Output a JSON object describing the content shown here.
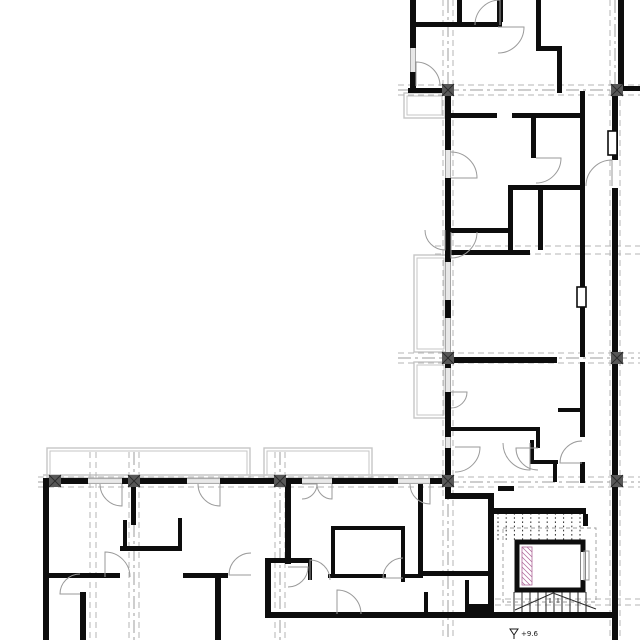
{
  "meta": {
    "title": "Apartment building floor plan",
    "type": "architectural-plan"
  },
  "annotations": {
    "level": "+9.6"
  },
  "colors": {
    "wall": "#0d0d0d",
    "grid_dash": "#b5b5b5",
    "grid_center": "#9e9e9e",
    "door": "#9a9a9a",
    "window": "#8f8f8f",
    "window_mid": "#c4c4c4",
    "balcony": "#c6c6c6",
    "column": "#585858",
    "column_x": "#2a2a2a",
    "hatch": "#b06a9a",
    "tread": "#2a2a2a",
    "walkline": "#9b9b9b",
    "text": "#1a1a1a"
  },
  "canvas": {
    "w": 640,
    "h": 640
  },
  "walls": [
    [
      410,
      0,
      6,
      48
    ],
    [
      410,
      72,
      6,
      21
    ],
    [
      410,
      22,
      92,
      5
    ],
    [
      457,
      0,
      5,
      22
    ],
    [
      497,
      0,
      6,
      22
    ],
    [
      536,
      0,
      5,
      50
    ],
    [
      536,
      46,
      26,
      5
    ],
    [
      557,
      46,
      5,
      47
    ],
    [
      618,
      0,
      6,
      90
    ],
    [
      612,
      86,
      28,
      5
    ],
    [
      408,
      88,
      40,
      5
    ],
    [
      445,
      93,
      6,
      57
    ],
    [
      445,
      178,
      6,
      84
    ],
    [
      445,
      300,
      6,
      18
    ],
    [
      445,
      352,
      6,
      16
    ],
    [
      445,
      392,
      6,
      45
    ],
    [
      445,
      448,
      6,
      45
    ],
    [
      612,
      91,
      6,
      69
    ],
    [
      612,
      188,
      6,
      452
    ],
    [
      451,
      113,
      46,
      5
    ],
    [
      512,
      113,
      70,
      5
    ],
    [
      531,
      113,
      5,
      45
    ],
    [
      508,
      185,
      77,
      5
    ],
    [
      508,
      190,
      5,
      63
    ],
    [
      451,
      228,
      57,
      5
    ],
    [
      451,
      250,
      79,
      5
    ],
    [
      538,
      190,
      5,
      60
    ],
    [
      580,
      91,
      5,
      146
    ],
    [
      580,
      237,
      5,
      50
    ],
    [
      580,
      305,
      5,
      52
    ],
    [
      580,
      362,
      5,
      50
    ],
    [
      580,
      412,
      5,
      25
    ],
    [
      580,
      462,
      5,
      21
    ],
    [
      451,
      357,
      106,
      6
    ],
    [
      558,
      408,
      24,
      4
    ],
    [
      448,
      427,
      92,
      4
    ],
    [
      536,
      427,
      4,
      21
    ],
    [
      445,
      493,
      47,
      6
    ],
    [
      488,
      493,
      6,
      125
    ],
    [
      498,
      486,
      16,
      5
    ],
    [
      530,
      440,
      4,
      24
    ],
    [
      530,
      460,
      28,
      4
    ],
    [
      553,
      460,
      4,
      22
    ],
    [
      488,
      508,
      98,
      6
    ],
    [
      488,
      612,
      124,
      6
    ],
    [
      583,
      514,
      5,
      12
    ],
    [
      43,
      478,
      45,
      6
    ],
    [
      122,
      478,
      65,
      6
    ],
    [
      220,
      478,
      82,
      6
    ],
    [
      332,
      478,
      66,
      6
    ],
    [
      430,
      478,
      21,
      6
    ],
    [
      43,
      484,
      6,
      156
    ],
    [
      131,
      484,
      5,
      41
    ],
    [
      120,
      546,
      62,
      5
    ],
    [
      178,
      518,
      4,
      30
    ],
    [
      123,
      520,
      4,
      28
    ],
    [
      43,
      573,
      77,
      5
    ],
    [
      183,
      573,
      45,
      5
    ],
    [
      80,
      592,
      6,
      48
    ],
    [
      215,
      573,
      6,
      67
    ],
    [
      265,
      558,
      6,
      60
    ],
    [
      265,
      558,
      47,
      5
    ],
    [
      308,
      558,
      4,
      22
    ],
    [
      285,
      484,
      6,
      80
    ],
    [
      331,
      526,
      4,
      52
    ],
    [
      331,
      526,
      74,
      4
    ],
    [
      401,
      526,
      4,
      56
    ],
    [
      418,
      484,
      5,
      94
    ],
    [
      328,
      574,
      58,
      4
    ],
    [
      403,
      574,
      20,
      4
    ],
    [
      423,
      571,
      67,
      5
    ],
    [
      265,
      612,
      225,
      6
    ],
    [
      468,
      604,
      23,
      8
    ],
    [
      424,
      592,
      4,
      20
    ],
    [
      465,
      580,
      4,
      32
    ]
  ],
  "windows": [
    {
      "x": 410,
      "y": 48,
      "w": 6,
      "h": 24,
      "o": "v"
    },
    {
      "x": 445,
      "y": 150,
      "w": 6,
      "h": 28,
      "o": "v"
    },
    {
      "x": 445,
      "y": 262,
      "w": 6,
      "h": 38,
      "o": "v"
    },
    {
      "x": 445,
      "y": 318,
      "w": 6,
      "h": 34,
      "o": "v"
    },
    {
      "x": 445,
      "y": 368,
      "w": 6,
      "h": 24,
      "o": "v"
    },
    {
      "x": 445,
      "y": 437,
      "w": 6,
      "h": 11,
      "o": "v"
    },
    {
      "x": 88,
      "y": 478,
      "w": 34,
      "h": 6,
      "o": "h"
    },
    {
      "x": 187,
      "y": 478,
      "w": 33,
      "h": 6,
      "o": "h"
    },
    {
      "x": 302,
      "y": 478,
      "w": 30,
      "h": 6,
      "o": "h"
    },
    {
      "x": 398,
      "y": 478,
      "w": 32,
      "h": 6,
      "o": "h"
    }
  ],
  "gaps": [
    [
      612,
      160,
      6,
      28
    ]
  ],
  "frames": [
    [
      608,
      131,
      9,
      24
    ],
    [
      577,
      287,
      9,
      20
    ]
  ],
  "doors": [
    {
      "cx": 500,
      "cy": 25,
      "r": 25,
      "a1": 270,
      "a2": 180,
      "s": 0
    },
    {
      "cx": 498,
      "cy": 27,
      "r": 26,
      "a1": 0,
      "a2": 90,
      "s": 1
    },
    {
      "cx": 416,
      "cy": 86,
      "r": 24,
      "a1": 270,
      "a2": 0,
      "s": 1
    },
    {
      "cx": 536,
      "cy": 158,
      "r": 25,
      "a1": 0,
      "a2": 90,
      "s": 1
    },
    {
      "cx": 612,
      "cy": 186,
      "r": 26,
      "a1": 270,
      "a2": 180,
      "s": 0
    },
    {
      "cx": 451,
      "cy": 232,
      "r": 26,
      "a1": 90,
      "a2": 0,
      "s": 0
    },
    {
      "cx": 445,
      "cy": 230,
      "r": 20,
      "a1": 90,
      "a2": 180,
      "s": 1
    },
    {
      "cx": 451,
      "cy": 178,
      "r": 26,
      "a1": 0,
      "a2": 270,
      "s": 0
    },
    {
      "cx": 451,
      "cy": 392,
      "r": 16,
      "a1": 0,
      "a2": 90,
      "s": 1
    },
    {
      "cx": 538,
      "cy": 448,
      "r": 22,
      "a1": 180,
      "a2": 90,
      "s": 0
    },
    {
      "cx": 582,
      "cy": 463,
      "r": 22,
      "a1": 180,
      "a2": 270,
      "s": 1
    },
    {
      "cx": 455,
      "cy": 447,
      "r": 25,
      "a1": 0,
      "a2": 90,
      "s": 1
    },
    {
      "cx": 530,
      "cy": 443,
      "r": 27,
      "a1": 90,
      "a2": 180,
      "s": 1
    },
    {
      "cx": 122,
      "cy": 484,
      "r": 22,
      "a1": 90,
      "a2": 180,
      "s": 1
    },
    {
      "cx": 220,
      "cy": 484,
      "r": 22,
      "a1": 90,
      "a2": 180,
      "s": 1
    },
    {
      "cx": 302,
      "cy": 484,
      "r": 15,
      "a1": 0,
      "a2": 90,
      "s": 1
    },
    {
      "cx": 332,
      "cy": 484,
      "r": 15,
      "a1": 90,
      "a2": 180,
      "s": 1
    },
    {
      "cx": 430,
      "cy": 484,
      "r": 20,
      "a1": 90,
      "a2": 180,
      "s": 1
    },
    {
      "cx": 105,
      "cy": 577,
      "r": 25,
      "a1": 270,
      "a2": 0,
      "s": 1
    },
    {
      "cx": 80,
      "cy": 594,
      "r": 20,
      "a1": 180,
      "a2": 270,
      "s": 1
    },
    {
      "cx": 251,
      "cy": 575,
      "r": 22,
      "a1": 180,
      "a2": 270,
      "s": 1
    },
    {
      "cx": 310,
      "cy": 580,
      "r": 20,
      "a1": 270,
      "a2": 0,
      "s": 1
    },
    {
      "cx": 403,
      "cy": 578,
      "r": 20,
      "a1": 180,
      "a2": 270,
      "s": 1
    },
    {
      "cx": 337,
      "cy": 614,
      "r": 24,
      "a1": 270,
      "a2": 0,
      "s": 1
    },
    {
      "cx": 288,
      "cy": 567,
      "r": 20,
      "a1": 0,
      "a2": 90,
      "s": 1
    }
  ],
  "grids": {
    "v": [
      {
        "x": 448,
        "y1": 0,
        "y2": 640,
        "pair": 5,
        "center": true
      },
      {
        "x": 615,
        "y1": 0,
        "y2": 640,
        "pair": 5,
        "center": true
      },
      {
        "x": 134,
        "y1": 452,
        "y2": 640,
        "pair": 5,
        "center": true
      },
      {
        "x": 280,
        "y1": 452,
        "y2": 640,
        "pair": 5,
        "center": true
      },
      {
        "x": 93,
        "y1": 452,
        "y2": 640,
        "pair": 3,
        "center": false
      }
    ],
    "h": [
      {
        "y": 90,
        "x1": 398,
        "x2": 640,
        "pair": 5,
        "center": true
      },
      {
        "y": 250,
        "x1": 435,
        "x2": 640,
        "pair": 4,
        "center": false
      },
      {
        "y": 358,
        "x1": 398,
        "x2": 640,
        "pair": 5,
        "center": true
      },
      {
        "y": 482,
        "x1": 38,
        "x2": 640,
        "pair": 5,
        "center": true
      },
      {
        "y": 602,
        "x1": 495,
        "x2": 640,
        "pair": 3,
        "center": false
      }
    ]
  },
  "columns": {
    "size": 12,
    "points": [
      [
        448,
        90
      ],
      [
        617,
        90
      ],
      [
        448,
        358
      ],
      [
        617,
        358
      ],
      [
        55,
        481
      ],
      [
        134,
        481
      ],
      [
        280,
        481
      ],
      [
        448,
        481
      ],
      [
        617,
        481
      ]
    ]
  },
  "balconies": [
    [
      47,
      448,
      203,
      30
    ],
    [
      264,
      448,
      108,
      30
    ],
    [
      414,
      255,
      33,
      97
    ],
    [
      414,
      362,
      33,
      56
    ],
    [
      404,
      93,
      41,
      25
    ]
  ],
  "gray_lines": [
    [
      43,
      475,
      448,
      475
    ]
  ],
  "stair": {
    "treads_top": {
      "x1": 498,
      "x2": 580,
      "n": 11,
      "y1": 513,
      "y2": 540,
      "dotted": true
    },
    "treads_bottom": {
      "x1": 514,
      "x2": 586,
      "n": 10,
      "y1": 592,
      "y2": 612,
      "dotted": false
    },
    "arrow": [
      [
        515,
        610
      ],
      [
        553,
        593
      ],
      [
        596,
        609
      ]
    ],
    "walkline": [
      503,
      528,
      93,
      74
    ],
    "label_ticks": [
      [
        546,
        598
      ],
      [
        550,
        598
      ],
      [
        554,
        598
      ],
      [
        558,
        598
      ]
    ]
  },
  "elevator": {
    "x": 517,
    "y": 542,
    "w": 66,
    "h": 48,
    "t": 5,
    "door_gap": {
      "y1": 552,
      "y2": 580
    },
    "hatch": [
      522,
      547,
      10,
      38
    ],
    "slider": [
      584,
      551,
      5,
      29
    ]
  },
  "level_marker": {
    "tri": [
      [
        510,
        629
      ],
      [
        518,
        629
      ],
      [
        514,
        635
      ]
    ],
    "tick": [
      514,
      635,
      514,
      639
    ],
    "text_x": 521,
    "text_y": 636
  }
}
